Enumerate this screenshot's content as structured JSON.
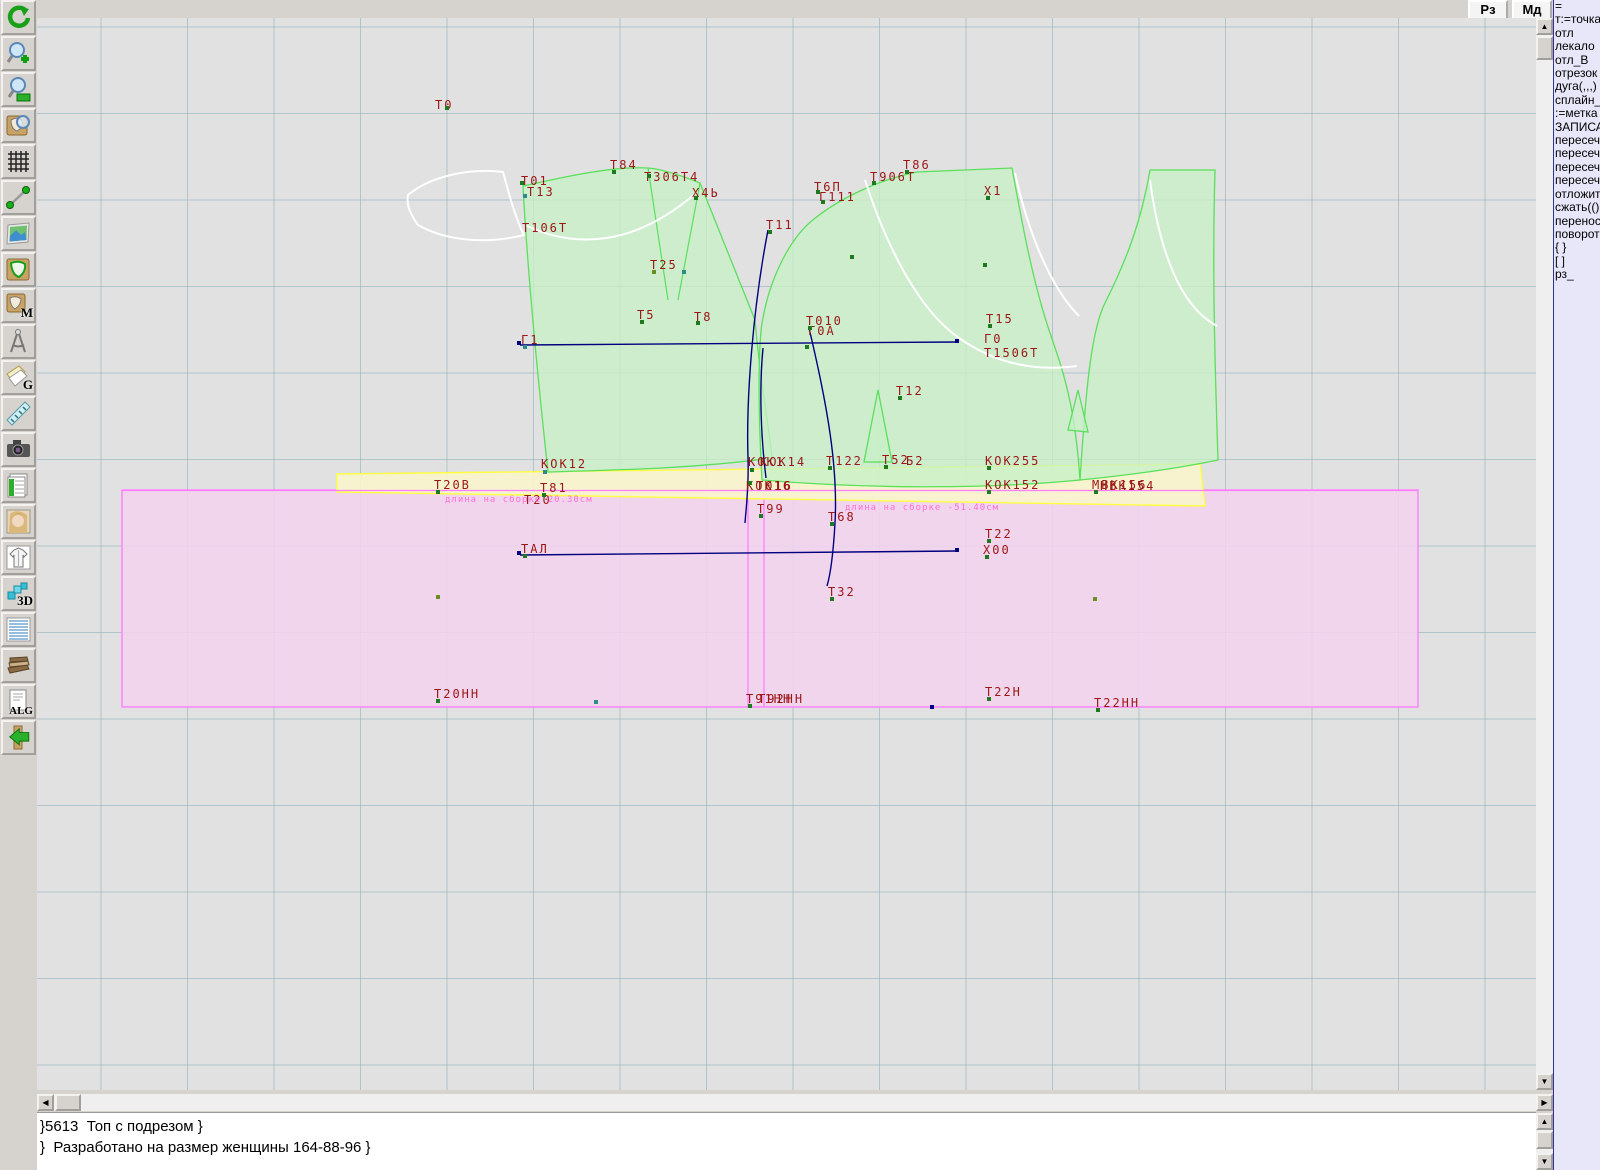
{
  "window": {
    "top_buttons": [
      {
        "label": "Рз"
      },
      {
        "label": "Мд"
      }
    ]
  },
  "toolbar": {
    "items": [
      {
        "name": "refresh-icon",
        "label": ""
      },
      {
        "name": "zoom-in-icon",
        "label": ""
      },
      {
        "name": "zoom-out-icon",
        "label": ""
      },
      {
        "name": "piece-preview-icon",
        "label": ""
      },
      {
        "name": "grid-icon",
        "label": ""
      },
      {
        "name": "segment-icon",
        "label": ""
      },
      {
        "name": "image-icon",
        "label": ""
      },
      {
        "name": "pattern-piece-icon",
        "label": ""
      },
      {
        "name": "measurements-icon",
        "label": "M"
      },
      {
        "name": "compass-icon",
        "label": "W"
      },
      {
        "name": "gracia-icon",
        "label": "G"
      },
      {
        "name": "ruler-icon",
        "label": ""
      },
      {
        "name": "camera-icon",
        "label": ""
      },
      {
        "name": "table-icon",
        "label": ""
      },
      {
        "name": "portrait-icon",
        "label": ""
      },
      {
        "name": "garment-icon",
        "label": ""
      },
      {
        "name": "3d-icon",
        "label": "3D"
      },
      {
        "name": "list-icon",
        "label": ""
      },
      {
        "name": "books-icon",
        "label": ""
      },
      {
        "name": "algorithm-icon",
        "label": "ALG"
      },
      {
        "name": "exit-icon",
        "label": ""
      }
    ]
  },
  "panel": {
    "items": [
      "=",
      "т:=точка",
      "отл",
      "лекало",
      "отл_В",
      "отрезок",
      "дуга(,,,)",
      "сплайн_",
      ":=метка",
      "ЗАПИСА",
      "пересеч",
      "пересеч",
      "пересеч",
      "пересеч",
      "отложит",
      "сжать(()",
      "перенос",
      "поворот",
      "{ }",
      "[ ]",
      "рз_"
    ]
  },
  "status": {
    "line1": "}5613  Топ с подрезом }",
    "line2": "}  Разработано на размер женщины 164-88-96 }"
  },
  "canvas": {
    "colors": {
      "label": "#9c1616",
      "green_fill": "#c6f0c6",
      "green_stroke": "#5ae05a",
      "pink_fill": "#f2d3ee",
      "magenta": "#ff7dff",
      "yellow_fill": "#f8f4cd",
      "yellow_stroke": "#ffff42",
      "navy": "#00007e",
      "note_pink": "#ff6fd8"
    },
    "labels": [
      {
        "t": "Т0",
        "x": 398,
        "y": 80
      },
      {
        "t": "Т84",
        "x": 573,
        "y": 140
      },
      {
        "t": "Т306Т4",
        "x": 607,
        "y": 152
      },
      {
        "t": "Х4Ь",
        "x": 655,
        "y": 168
      },
      {
        "t": "Т01",
        "x": 484,
        "y": 156
      },
      {
        "t": "Т13",
        "x": 490,
        "y": 167
      },
      {
        "t": "Т106Т",
        "x": 485,
        "y": 203
      },
      {
        "t": "Т86",
        "x": 866,
        "y": 140
      },
      {
        "t": "Т906Т",
        "x": 833,
        "y": 152
      },
      {
        "t": "Т6П",
        "x": 777,
        "y": 162
      },
      {
        "t": "Г111",
        "x": 782,
        "y": 172
      },
      {
        "t": "Х1",
        "x": 947,
        "y": 166
      },
      {
        "t": "Т11",
        "x": 729,
        "y": 200
      },
      {
        "t": "Т25",
        "x": 613,
        "y": 240
      },
      {
        "t": "Т5",
        "x": 600,
        "y": 290
      },
      {
        "t": "Т8",
        "x": 657,
        "y": 292
      },
      {
        "t": "Т010",
        "x": 769,
        "y": 296
      },
      {
        "t": "Г0А",
        "x": 771,
        "y": 306
      },
      {
        "t": "Т15",
        "x": 949,
        "y": 294
      },
      {
        "t": "Г0",
        "x": 947,
        "y": 314
      },
      {
        "t": "Т1506Т",
        "x": 947,
        "y": 328
      },
      {
        "t": "Г1",
        "x": 484,
        "y": 315
      },
      {
        "t": "Т12",
        "x": 859,
        "y": 366
      },
      {
        "t": "КОК12",
        "x": 504,
        "y": 439
      },
      {
        "t": "КОК1",
        "x": 711,
        "y": 437
      },
      {
        "t": "КОК14",
        "x": 723,
        "y": 437
      },
      {
        "t": "Т122",
        "x": 789,
        "y": 436
      },
      {
        "t": "Т52",
        "x": 845,
        "y": 435
      },
      {
        "t": "Б2",
        "x": 869,
        "y": 436
      },
      {
        "t": "КОК255",
        "x": 948,
        "y": 436
      },
      {
        "t": "КОК16",
        "x": 709,
        "y": 461
      },
      {
        "t": "Т016",
        "x": 719,
        "y": 461
      },
      {
        "t": "Т20В",
        "x": 397,
        "y": 460
      },
      {
        "t": "Т81",
        "x": 503,
        "y": 463
      },
      {
        "t": "Т20",
        "x": 487,
        "y": 475
      },
      {
        "t": "КОК152",
        "x": 948,
        "y": 460
      },
      {
        "t": "МВК156",
        "x": 1055,
        "y": 460
      },
      {
        "t": "НВК154",
        "x": 1063,
        "y": 461
      },
      {
        "t": "Т99",
        "x": 720,
        "y": 484
      },
      {
        "t": "Т68",
        "x": 791,
        "y": 492
      },
      {
        "t": "ТАЛ",
        "x": 484,
        "y": 524
      },
      {
        "t": "Т22",
        "x": 948,
        "y": 509
      },
      {
        "t": "Х00",
        "x": 946,
        "y": 525
      },
      {
        "t": "Т32",
        "x": 791,
        "y": 567
      },
      {
        "t": "Т20НН",
        "x": 397,
        "y": 669
      },
      {
        "t": "Т91НН",
        "x": 709,
        "y": 674
      },
      {
        "t": "Т92НН",
        "x": 721,
        "y": 674
      },
      {
        "t": "Т22Н",
        "x": 948,
        "y": 667
      },
      {
        "t": "Т22НН",
        "x": 1057,
        "y": 678
      }
    ],
    "pink_notes": [
      {
        "t": "длина на сборке 20.30см",
        "x": 408,
        "y": 477
      },
      {
        "t": "длина на сборке -51.40см",
        "x": 808,
        "y": 485
      }
    ],
    "markers": [
      [
        408,
        88,
        "#1f7a1f"
      ],
      [
        483,
        163,
        "#1f7a1f"
      ],
      [
        486,
        176,
        "#2e8b8b"
      ],
      [
        575,
        152,
        "#1f7a1f"
      ],
      [
        610,
        156,
        "#1f7a1f"
      ],
      [
        657,
        178,
        "#1f7a1f"
      ],
      [
        868,
        152,
        "#1f7a1f"
      ],
      [
        835,
        163,
        "#1f7a1f"
      ],
      [
        779,
        172,
        "#1f7a1f"
      ],
      [
        784,
        182,
        "#1f7a1f"
      ],
      [
        949,
        178,
        "#1f7a1f"
      ],
      [
        731,
        212,
        "#1f7a1f"
      ],
      [
        615,
        252,
        "#6b8e23"
      ],
      [
        603,
        302,
        "#1f7a1f"
      ],
      [
        659,
        303,
        "#1f7a1f"
      ],
      [
        771,
        308,
        "#1f7a1f"
      ],
      [
        951,
        306,
        "#1f7a1f"
      ],
      [
        486,
        327,
        "#2e8b8b"
      ],
      [
        861,
        378,
        "#1f7a1f"
      ],
      [
        506,
        452,
        "#2e8b8b"
      ],
      [
        713,
        450,
        "#1f7a1f"
      ],
      [
        791,
        448,
        "#1f7a1f"
      ],
      [
        847,
        447,
        "#1f7a1f"
      ],
      [
        950,
        448,
        "#1f7a1f"
      ],
      [
        399,
        472,
        "#1f7a1f"
      ],
      [
        505,
        475,
        "#1f7a1f"
      ],
      [
        950,
        472,
        "#1f7a1f"
      ],
      [
        1057,
        472,
        "#1f7a1f"
      ],
      [
        722,
        496,
        "#1f7a1f"
      ],
      [
        793,
        504,
        "#1f7a1f"
      ],
      [
        486,
        536,
        "#1f7a1f"
      ],
      [
        950,
        521,
        "#1f7a1f"
      ],
      [
        948,
        537,
        "#1f7a1f"
      ],
      [
        793,
        579,
        "#1f7a1f"
      ],
      [
        399,
        681,
        "#1f7a1f"
      ],
      [
        711,
        686,
        "#1f7a1f"
      ],
      [
        950,
        679,
        "#1f7a1f"
      ],
      [
        1059,
        690,
        "#1f7a1f"
      ],
      [
        399,
        577,
        "#6b8e23"
      ],
      [
        1056,
        579,
        "#6b8e23"
      ],
      [
        893,
        687,
        "#000080"
      ],
      [
        557,
        682,
        "#2e8b8b"
      ],
      [
        711,
        463,
        "#1f7a1f"
      ],
      [
        645,
        252,
        "#2e8b8b"
      ],
      [
        813,
        237,
        "#1f7a1f"
      ],
      [
        946,
        245,
        "#1f7a1f"
      ],
      [
        768,
        327,
        "#1f7a1f"
      ],
      [
        480,
        323,
        "#000080"
      ],
      [
        918,
        321,
        "#000080"
      ],
      [
        480,
        533,
        "#000080"
      ],
      [
        918,
        530,
        "#000080"
      ]
    ]
  }
}
